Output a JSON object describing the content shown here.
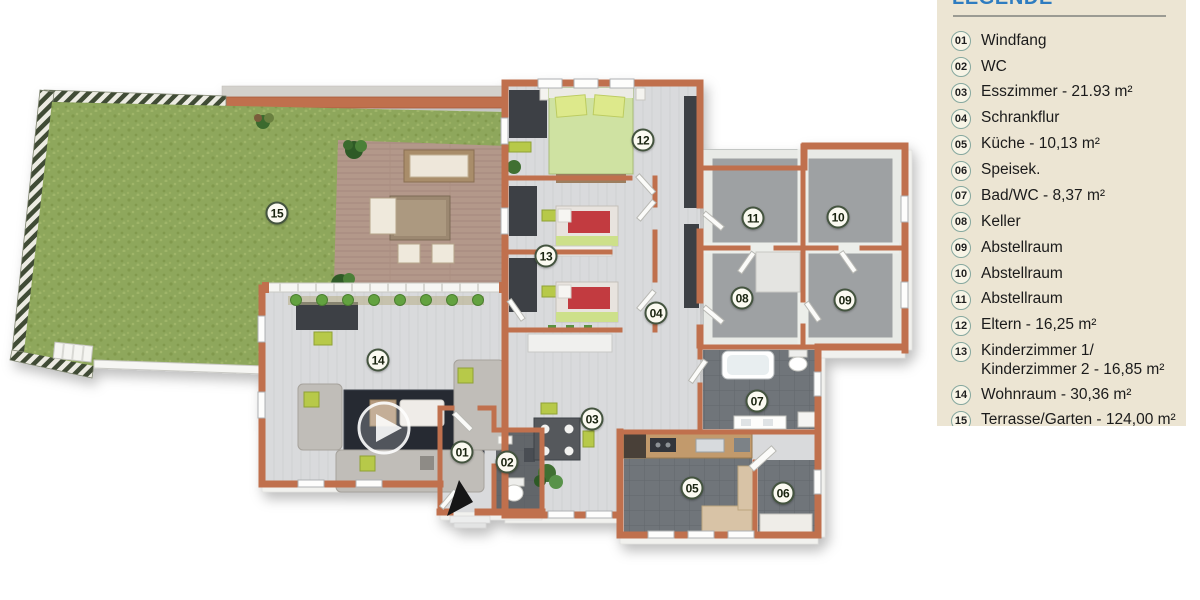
{
  "legend": {
    "title": "LEGENDE",
    "items": [
      {
        "num": "01",
        "lines": [
          "Windfang"
        ]
      },
      {
        "num": "02",
        "lines": [
          "WC"
        ]
      },
      {
        "num": "03",
        "lines": [
          "Esszimmer - 21.93 m²"
        ]
      },
      {
        "num": "04",
        "lines": [
          "Schrankflur"
        ]
      },
      {
        "num": "05",
        "lines": [
          "Küche - 10,13 m²"
        ]
      },
      {
        "num": "06",
        "lines": [
          "Speisek."
        ]
      },
      {
        "num": "07",
        "lines": [
          "Bad/WC - 8,37 m²"
        ]
      },
      {
        "num": "08",
        "lines": [
          "Keller"
        ]
      },
      {
        "num": "09",
        "lines": [
          "Abstellraum"
        ]
      },
      {
        "num": "10",
        "lines": [
          "Abstellraum"
        ]
      },
      {
        "num": "11",
        "lines": [
          "Abstellraum"
        ]
      },
      {
        "num": "12",
        "lines": [
          "Eltern - 16,25 m²"
        ]
      },
      {
        "num": "13",
        "lines": [
          "Kinderzimmer 1/",
          "Kinderzimmer 2 - 16,85 m²"
        ]
      },
      {
        "num": "14",
        "lines": [
          "Wohnraum - 30,36 m²"
        ]
      },
      {
        "num": "15",
        "lines": [
          "Terrasse/Garten - 124,00 m²"
        ]
      }
    ]
  },
  "floorplan": {
    "badges": [
      {
        "num": "01",
        "x": 462,
        "y": 452
      },
      {
        "num": "02",
        "x": 507,
        "y": 462
      },
      {
        "num": "03",
        "x": 592,
        "y": 419
      },
      {
        "num": "04",
        "x": 656,
        "y": 313
      },
      {
        "num": "05",
        "x": 692,
        "y": 488
      },
      {
        "num": "06",
        "x": 783,
        "y": 493
      },
      {
        "num": "07",
        "x": 757,
        "y": 401
      },
      {
        "num": "08",
        "x": 742,
        "y": 298
      },
      {
        "num": "09",
        "x": 845,
        "y": 300
      },
      {
        "num": "10",
        "x": 838,
        "y": 217
      },
      {
        "num": "11",
        "x": 753,
        "y": 218
      },
      {
        "num": "12",
        "x": 643,
        "y": 140
      },
      {
        "num": "13",
        "x": 546,
        "y": 256
      },
      {
        "num": "14",
        "x": 378,
        "y": 360
      },
      {
        "num": "15",
        "x": 277,
        "y": 213
      }
    ]
  },
  "colors": {
    "panel_bg": "#ece5d3",
    "title_blue": "#2e7cc0",
    "divider": "#9b9b93",
    "text": "#1b1b1b",
    "wall": "#c06f4e",
    "grass": "#8ea75b",
    "deck": "#b3988a",
    "floor_light": "#d9dadc",
    "floor_dark": "#70757a",
    "badge_border": "#44543f",
    "badge_bg": "#fbfaf1",
    "lime": "#b7c94a"
  }
}
